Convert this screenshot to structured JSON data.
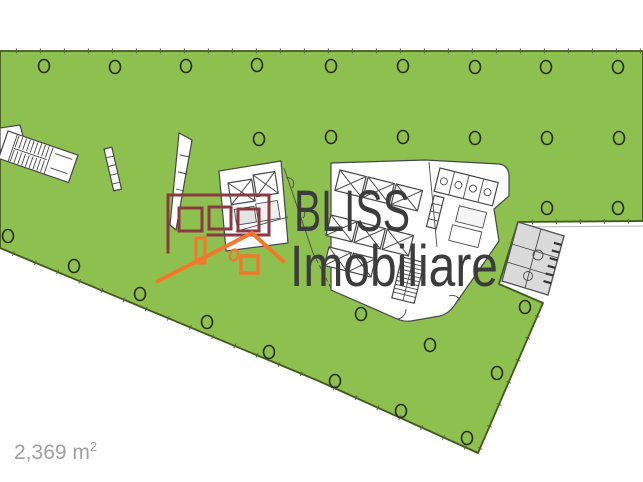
{
  "image_type": "real-estate-floor-plan",
  "watermark": {
    "line1": "BLISS",
    "line2": "Imobiliare"
  },
  "area_label": {
    "main": "2,369 m",
    "sup": "2",
    "full_text": "2,369 m²"
  },
  "colors": {
    "floor_green": "#8dc04f",
    "floor_edge": "#42581c",
    "tick": "#55663f",
    "marker_stroke": "#262d1c",
    "plan_line": "#474747",
    "room_gray_fill": "#dadada",
    "room_gray_line": "#565656",
    "logo_maroon": "#8a3a43",
    "logo_orange": "#f4772d",
    "watermark_gray": "#3c3c3c",
    "area_label_gray": "#a0a0a0"
  },
  "plan_geometry": {
    "green_polygon": [
      [
        0,
        51
      ],
      [
        643,
        51
      ],
      [
        643,
        221
      ],
      [
        518,
        222
      ],
      [
        499,
        284
      ],
      [
        543,
        303
      ],
      [
        478,
        453
      ],
      [
        321,
        382
      ],
      [
        0,
        248
      ]
    ],
    "tick_spacing": 24,
    "tick_length": 5,
    "tick_edges": [
      [
        2,
        51,
        643,
        51
      ],
      [
        518,
        222,
        643,
        221
      ],
      [
        0,
        248,
        321,
        382
      ],
      [
        321,
        382,
        478,
        453
      ],
      [
        543,
        303,
        478,
        453
      ]
    ],
    "column_markers": [
      [
        44,
        66
      ],
      [
        115,
        67
      ],
      [
        186,
        66
      ],
      [
        257,
        65
      ],
      [
        331,
        66
      ],
      [
        403,
        66
      ],
      [
        475,
        67
      ],
      [
        546,
        67
      ],
      [
        618,
        67
      ],
      [
        259,
        139
      ],
      [
        331,
        137
      ],
      [
        403,
        137
      ],
      [
        475,
        138
      ],
      [
        547,
        138
      ],
      [
        619,
        138
      ],
      [
        547,
        208
      ],
      [
        618,
        208
      ],
      [
        8,
        236
      ],
      [
        74,
        266
      ],
      [
        140,
        294
      ],
      [
        207,
        322
      ],
      [
        269,
        352
      ],
      [
        335,
        381
      ],
      [
        401,
        411
      ],
      [
        467,
        438
      ],
      [
        525,
        307
      ],
      [
        497,
        373
      ],
      [
        361,
        314
      ],
      [
        430,
        345
      ]
    ],
    "marker_rx": 5.5,
    "marker_ry": 6.5
  }
}
